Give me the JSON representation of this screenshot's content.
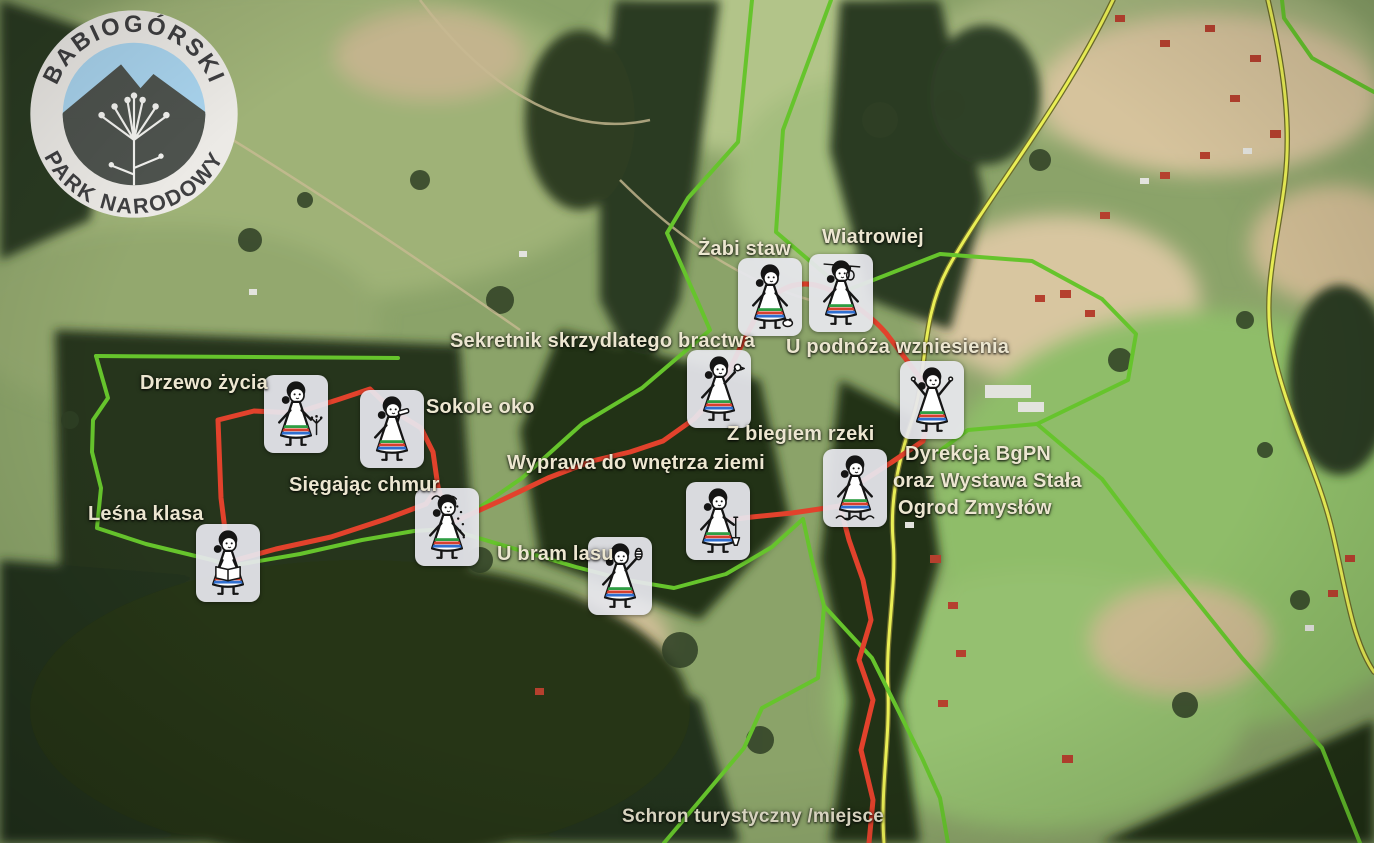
{
  "logo": {
    "top": "BABIOGÓRSKI",
    "bottom": "PARK NARODOWY"
  },
  "stations": [
    {
      "name": "Żabi staw",
      "icon": "girl-with-frog-icon"
    },
    {
      "name": "Wiatrowiej",
      "icon": "girl-with-anemometer-icon"
    },
    {
      "name": "Sekretnik skrzydlatego bractwa",
      "icon": "girl-with-bird-icon"
    },
    {
      "name": "U podnóża wzniesienia",
      "icon": "girl-arms-raised-icon"
    },
    {
      "name": "Drzewo życia",
      "icon": "girl-with-plant-icon"
    },
    {
      "name": "Sokole oko",
      "icon": "girl-with-spyglass-icon"
    },
    {
      "name": "Z biegiem rzeki",
      "icon": "girl-in-stream-icon"
    },
    {
      "name": "Wyprawa do wnętrza ziemi",
      "icon": "girl-with-shovel-icon"
    },
    {
      "name": "Sięgając chmur",
      "icon": "girl-with-snowfall-icon"
    },
    {
      "name": "Leśna klasa",
      "icon": "girl-reading-book-icon"
    },
    {
      "name": "U bram lasu",
      "icon": "girl-with-pinecone-icon"
    }
  ],
  "hq_label": {
    "lines": [
      "Dyrekcja BgPN",
      "oraz Wystawa Stała",
      "Ogrod Zmysłów"
    ]
  },
  "footnote": "Schron turystyczny /miejsce",
  "colors": {
    "red_trail": "#e2422c",
    "green_trail": "#66c42c",
    "road_yellow": "#e9ee55",
    "label_text": "#ece6d0",
    "tile_background": "#e7e7ee"
  }
}
